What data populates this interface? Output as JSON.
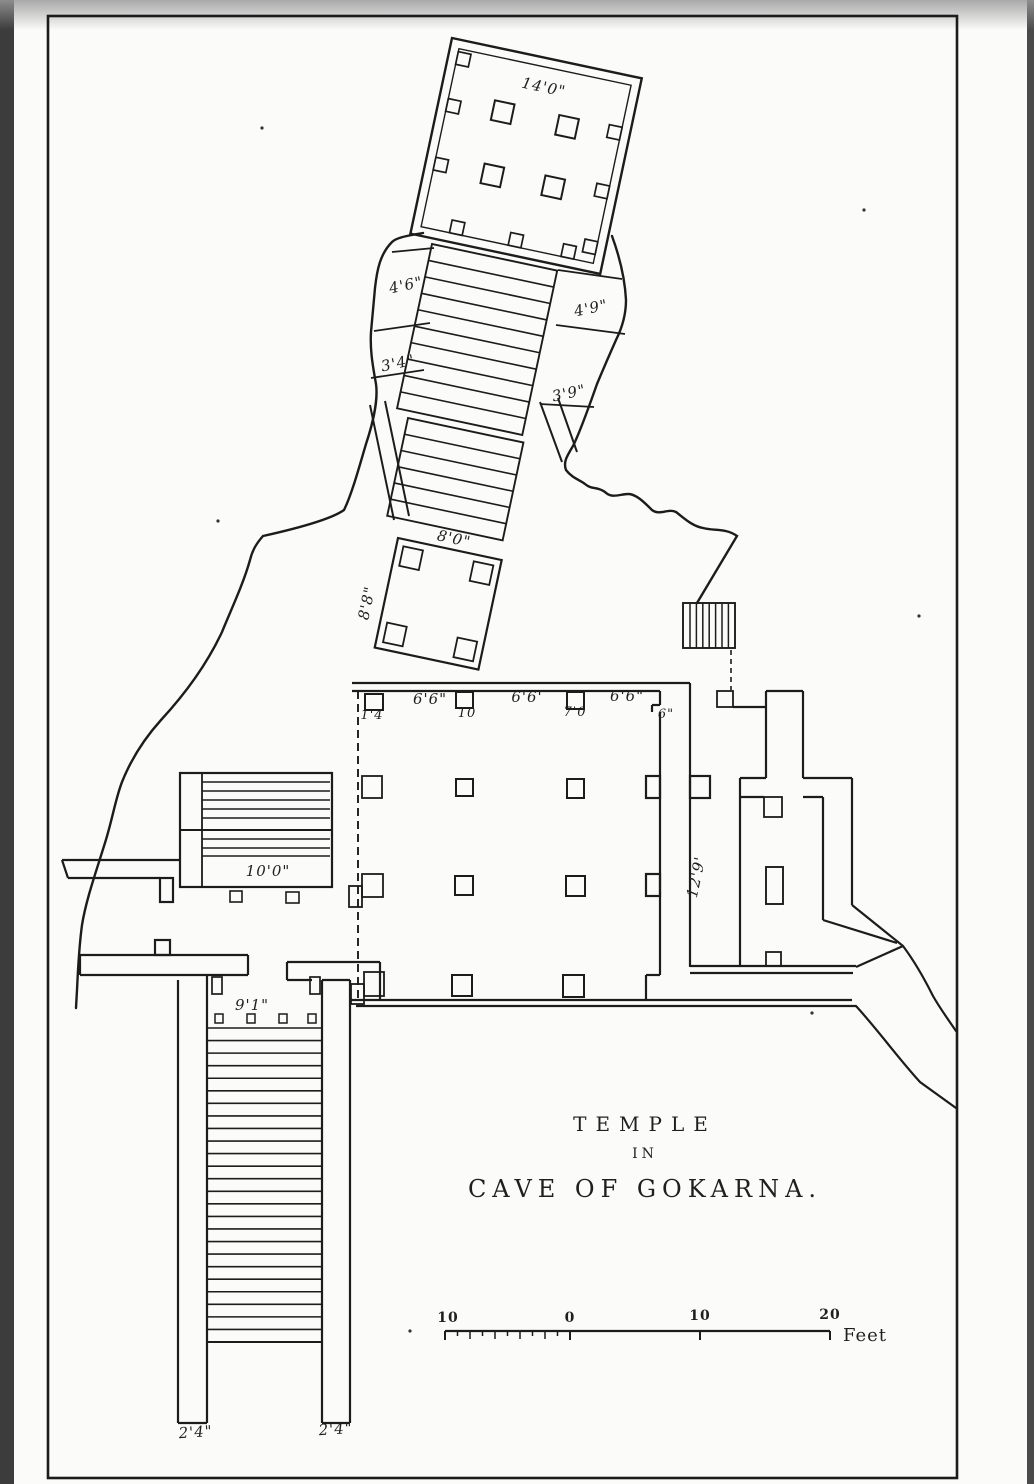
{
  "plate": {
    "title": {
      "line1": "TEMPLE",
      "line2": "IN",
      "line3": "CAVE OF GOKARNA."
    },
    "labels": {
      "mandapa_width": "14'0\"",
      "terrace_upper_left": "4'6\"",
      "terrace_upper_right": "4'9\"",
      "terrace_lower_left": "3'4\"",
      "terrace_lower_right": "3'9\"",
      "shrine_width": "8'0\"",
      "shrine_depth": "8'8\"",
      "hall_pillar1": "1'4",
      "hall_span1": "6'6\"",
      "hall_pillar2": "10",
      "hall_span2": "6'6'",
      "hall_pillar3": "7'0",
      "hall_span3": "6'6\"",
      "hall_wall_thickness": "6\"",
      "annex_stair": "10'0\"",
      "chamber_depth": "12'9'",
      "entrance_width": "9'1\"",
      "wall_end_left": "2'4\"",
      "wall_end_right": "2'4\""
    },
    "scale": {
      "l0": "10",
      "l1": "0",
      "l2": "10",
      "l3": "20",
      "unit": "Feet"
    }
  }
}
